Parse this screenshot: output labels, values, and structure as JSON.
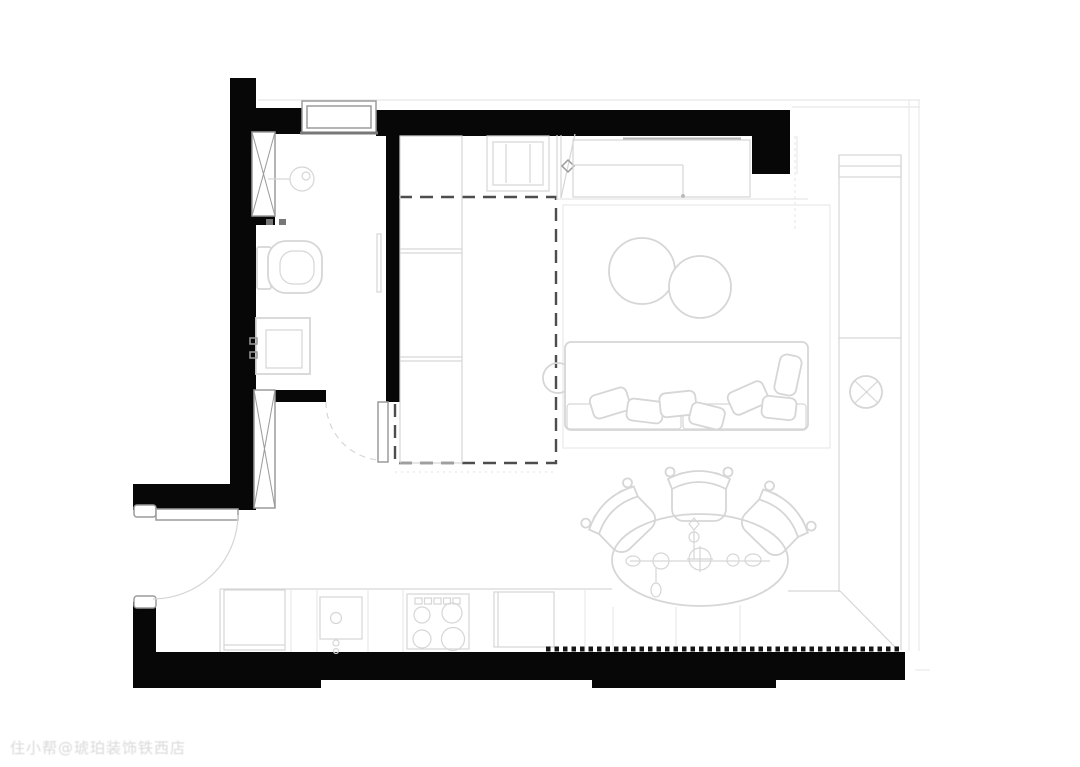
{
  "meta": {
    "kind": "interior floor plan",
    "description": "Black-wall architectural furniture layout plan of a studio apartment"
  },
  "watermark": {
    "text": "住小帮@琥珀装饰铁西店"
  },
  "colors": {
    "background": "#ffffff",
    "wall": "#070707",
    "furniture_line": "#d6d6d6",
    "faint_line": "#e8e8e8",
    "frame_line": "#9b9b9b",
    "dashed_line": "#4d4d4d"
  },
  "rooms": [
    {
      "name": "bathroom"
    },
    {
      "name": "entry-hall"
    },
    {
      "name": "dashed-closet-zone"
    },
    {
      "name": "kitchen"
    },
    {
      "name": "living-area"
    },
    {
      "name": "dining-area"
    },
    {
      "name": "window-balcony-zone"
    }
  ],
  "fixtures": [
    "window",
    "entry-door",
    "bathroom-door",
    "toilet",
    "vanity-sink",
    "ceiling-light",
    "riser-shaft",
    "closet-cabinets",
    "built-in-appliance",
    "kitchen-counter",
    "fridge-cabinet",
    "kitchen-sink",
    "cooktop-4-burner",
    "dishwasher",
    "rug",
    "coffee-table",
    "sofa",
    "pillow",
    "side-table",
    "dining-table",
    "dining-chair",
    "exhaust-fan-symbol",
    "wardrobe-strip"
  ]
}
